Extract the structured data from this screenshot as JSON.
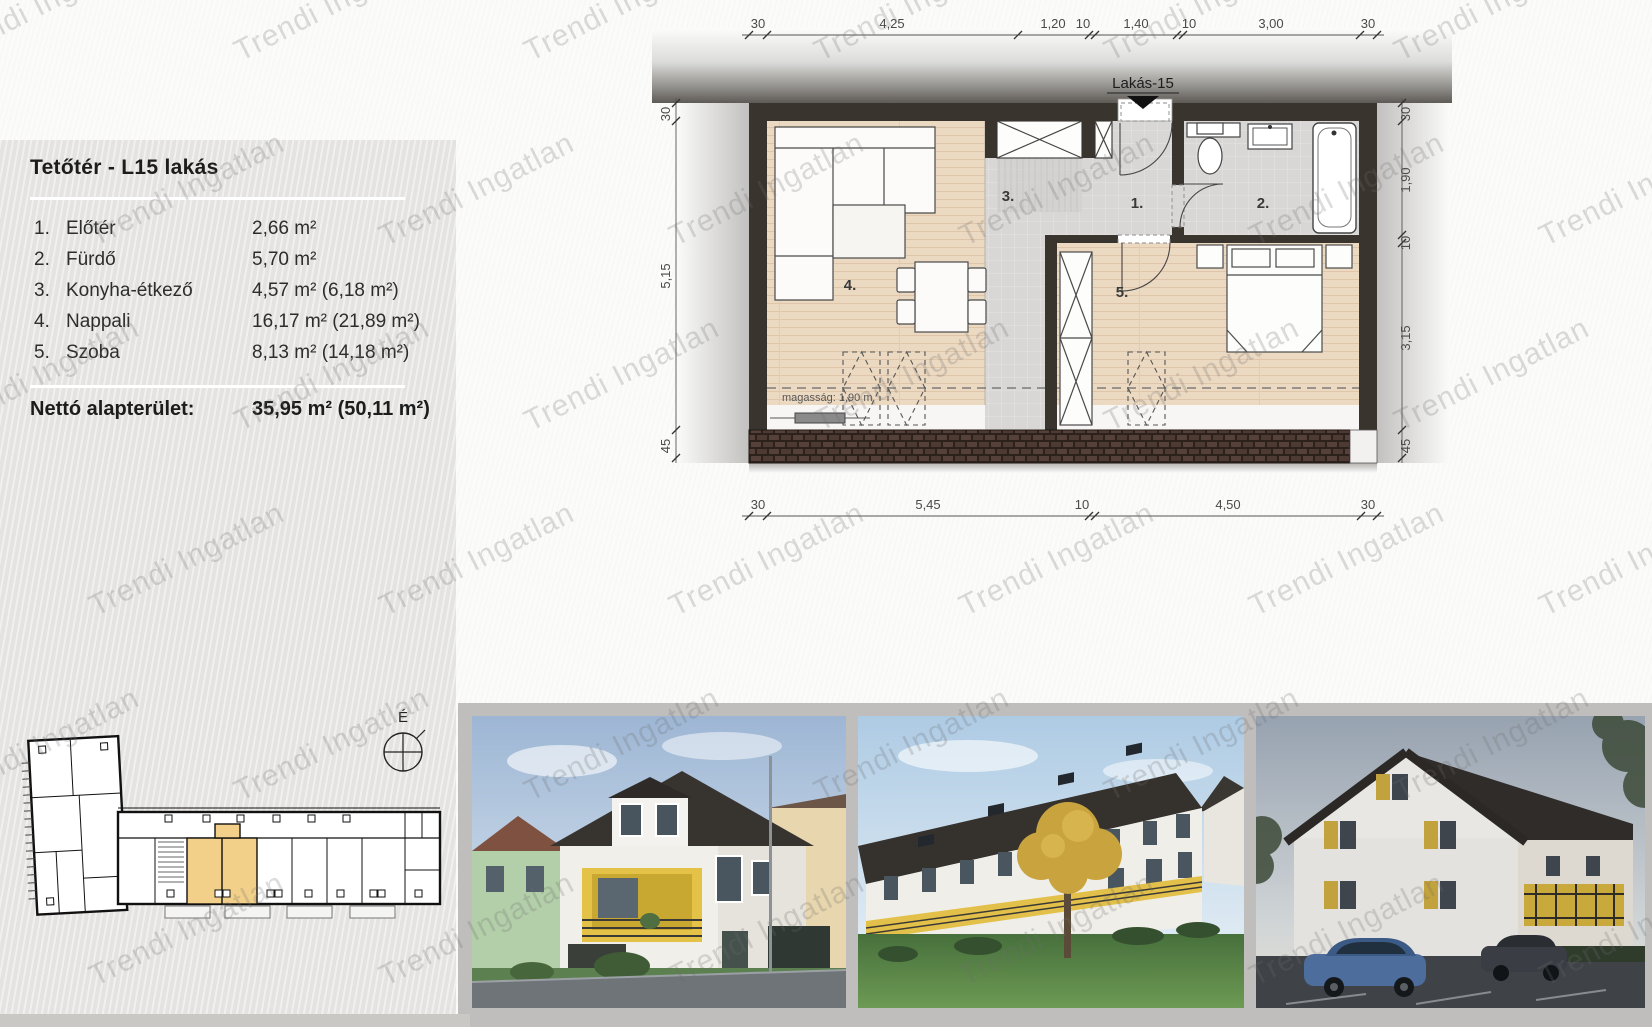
{
  "watermark": {
    "text": "Trendi Ingatlan"
  },
  "sidebar": {
    "title": "Tetőtér - L15 lakás",
    "rooms": [
      {
        "num": "1.",
        "name": "Előtér",
        "area": "2,66 m²"
      },
      {
        "num": "2.",
        "name": "Fürdő",
        "area": "5,70 m²"
      },
      {
        "num": "3.",
        "name": "Konyha-étkező",
        "area": "4,57 m² (6,18 m²)"
      },
      {
        "num": "4.",
        "name": "Nappali",
        "area": "16,17 m² (21,89 m²)"
      },
      {
        "num": "5.",
        "name": "Szoba",
        "area": "8,13 m² (14,18 m²)"
      }
    ],
    "total_label": "Nettó alapterület:",
    "total_value": "35,95 m² (50,11 m²)"
  },
  "floorplan": {
    "unit_label": "Lakás-15",
    "height_note": "magasság: 1,90 m",
    "room_numbers": [
      "1.",
      "2.",
      "3.",
      "4.",
      "5."
    ],
    "dims": {
      "top": [
        "30",
        "4,25",
        "1,20",
        "10",
        "1,40",
        "10",
        "3,00",
        "30"
      ],
      "bottom": [
        "30",
        "5,45",
        "10",
        "4,50",
        "30"
      ],
      "left": [
        "30",
        "5,15",
        "45"
      ],
      "right": [
        "30",
        "1,90",
        "10",
        "3,15",
        "45"
      ]
    }
  },
  "siteplan": {
    "north_label": "É"
  },
  "colors": {
    "accent_yellow": "#f2d089",
    "wall_dark": "#3a342e",
    "brick": "#503c34",
    "panel_gray": "#e4e3e1",
    "frame_gray": "#bfbebc",
    "wood_floor": "#ecd9c2",
    "tile_floor": "#d8d7d5"
  }
}
